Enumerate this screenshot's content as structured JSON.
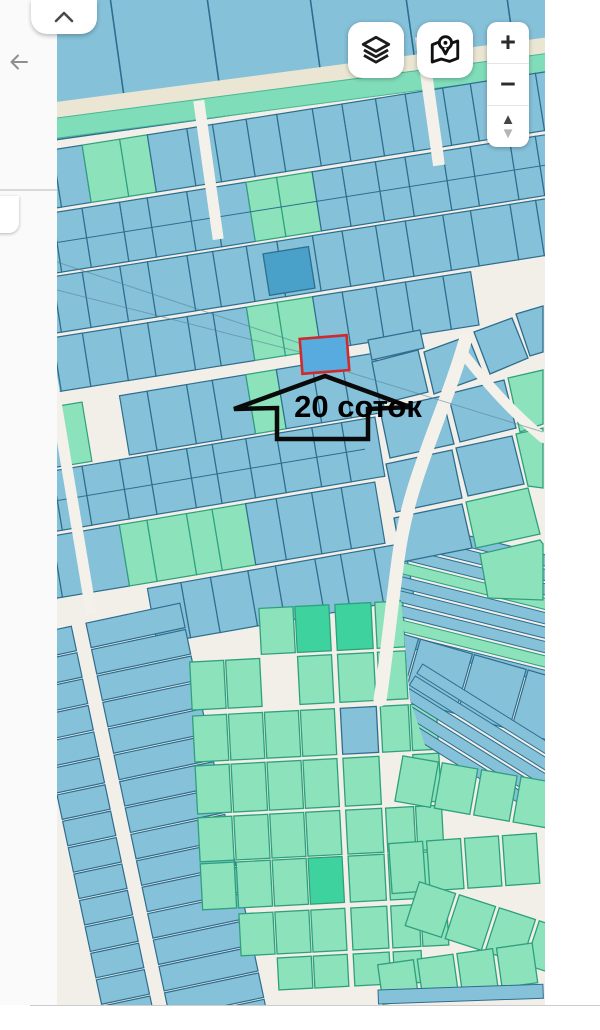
{
  "annotation": {
    "label": "20 соток"
  },
  "controls": {
    "layers": {
      "icon": "layers-icon"
    },
    "legend": {
      "icon": "map-location-icon"
    },
    "zoom": {
      "in": "+",
      "out": "−",
      "up": "▲",
      "down": "▼"
    }
  },
  "left_panel": {
    "back_icon": "arrow-left-icon"
  },
  "top_tab": {
    "icon": "chevron-up-icon"
  },
  "colors": {
    "map_bg": "#f2efe9",
    "parcel_blue": "#85c1d9",
    "parcel_blue_border": "#2e6d8e",
    "parcel_green": "#8ce2bb",
    "parcel_green_border": "#2fa07c",
    "parcel_dark_green": "#3ed39e",
    "parcel_dark_blue": "#49a0c8",
    "selected_fill": "#57abdf",
    "selected_border": "#d02a2a",
    "teal_band": "#80ddb9",
    "teal_band_border": "#49b795",
    "beige_band": "#eae6d3",
    "road_white": "#f4f1ea",
    "annotation_stroke": "#0a0a0a"
  },
  "map": {
    "clip": {
      "x": 57,
      "y": 0,
      "w": 488,
      "h": 1005
    },
    "top_parcels": {
      "rot": -8,
      "cx": 300,
      "cy": 55,
      "y": -70,
      "h": 175,
      "x0": 20,
      "widths": [
        100,
        96,
        102,
        95,
        100,
        95,
        80
      ]
    },
    "bands": {
      "rot": -7.5,
      "cx": 300,
      "cy": 88,
      "beige": {
        "x": 10,
        "y": 70,
        "w": 580,
        "h": 16
      },
      "teal": {
        "x": 10,
        "y": 86,
        "w": 580,
        "h": 20
      }
    },
    "strip_widths": [
      34,
      30,
      38,
      28,
      40,
      26,
      34,
      31,
      36,
      30
    ],
    "strips": [
      {
        "cy": 140,
        "h": 58,
        "rot": -9,
        "x0": 20,
        "x1": 580,
        "greens": [
          [
            85,
            155
          ]
        ]
      },
      {
        "cy": 204,
        "h": 60,
        "rot": -9,
        "x0": 20,
        "x1": 580,
        "greens": [
          [
            245,
            300
          ]
        ],
        "rows2": true
      },
      {
        "cy": 266,
        "h": 56,
        "rot": -9,
        "x0": 20,
        "x1": 580,
        "greens": []
      },
      {
        "cy": 326,
        "h": 54,
        "rot": -9,
        "x0": 20,
        "x1": 460,
        "greens": [
          [
            252,
            302
          ]
        ]
      },
      {
        "cy": 396,
        "h": 60,
        "rot": -9.5,
        "x0": 20,
        "x1": 366,
        "greens": [
          [
            58,
            84
          ],
          [
            250,
            290
          ]
        ],
        "skips": [
          [
            78,
            120
          ]
        ]
      },
      {
        "cy": 460,
        "h": 60,
        "rot": -9.5,
        "x0": 20,
        "x1": 366,
        "greens": [],
        "rows2": true
      },
      {
        "cy": 526,
        "h": 62,
        "rot": -9.5,
        "x0": 20,
        "x1": 366,
        "greens": [
          [
            120,
            210
          ],
          [
            225,
            255
          ]
        ]
      },
      {
        "cy": 590,
        "h": 56,
        "rot": -10,
        "x0": 150,
        "x1": 400,
        "greens": []
      }
    ],
    "slats": {
      "rot": -12,
      "cx": 140,
      "cy": 810,
      "y0": 616,
      "y1": 1040,
      "step": 27,
      "h": 25,
      "runs": [
        [
          62,
          49
        ],
        [
          126,
          96
        ]
      ]
    },
    "cluster": {
      "rot": -3,
      "cx": 310,
      "cy": 780,
      "rows": [
        {
          "y": 606,
          "h": 46
        },
        {
          "y": 656,
          "h": 48
        },
        {
          "y": 710,
          "h": 46
        },
        {
          "y": 760,
          "h": 48
        },
        {
          "y": 812,
          "h": 44
        },
        {
          "y": 858,
          "h": 46
        },
        {
          "y": 910,
          "h": 42
        },
        {
          "y": 956,
          "h": 32
        }
      ],
      "cols": [
        {
          "x": 196,
          "w": 34
        },
        {
          "x": 232,
          "w": 34
        },
        {
          "x": 268,
          "w": 34
        },
        {
          "x": 304,
          "w": 34
        },
        {
          "x": 344,
          "w": 36
        },
        {
          "x": 384,
          "w": 28
        },
        {
          "x": 414,
          "w": 26
        }
      ],
      "skips": [
        "0,0",
        "0,1",
        "0,6",
        "1,6",
        "1,2",
        "6,0",
        "7,0",
        "7,1",
        "7,6",
        "3,5"
      ],
      "darks": [
        "0,3",
        "0,4",
        "5,3"
      ],
      "blues": [
        "2,4"
      ]
    },
    "fan_clip": "392,500 545,500 545,820 450,820 410,700",
    "fanA": {
      "rot": 14,
      "cx": 470,
      "cy": 600,
      "x": 385,
      "w": 185,
      "y0": 538,
      "n": 9,
      "step": 14,
      "h": 11,
      "greens": [
        3,
        7
      ]
    },
    "fanB": {
      "rot": 16,
      "cx": 460,
      "cy": 690,
      "y": 652,
      "h": 62,
      "x0": 352,
      "cw": 54,
      "n": 4
    },
    "fanC": {
      "rot": 32,
      "cx": 490,
      "cy": 745,
      "x": 390,
      "w": 200,
      "y0": 712,
      "n": 5,
      "step": 14,
      "h": 11,
      "greens": []
    },
    "green_rows": [
      {
        "rot": 10,
        "cx": 470,
        "cy": 790,
        "y": 768,
        "h": 46,
        "x0": 398,
        "cw": 36,
        "gap": 4,
        "n": 4
      },
      {
        "rot": -4,
        "cx": 470,
        "cy": 860,
        "y": 838,
        "h": 50,
        "x0": 390,
        "cw": 34,
        "gap": 4,
        "n": 4
      },
      {
        "rot": 18,
        "cx": 490,
        "cy": 930,
        "y": 906,
        "h": 46,
        "x0": 408,
        "cw": 38,
        "gap": 4,
        "n": 4
      },
      {
        "rot": -8,
        "cx": 470,
        "cy": 975,
        "y": 952,
        "h": 40,
        "x0": 380,
        "cw": 36,
        "gap": 4,
        "n": 4
      }
    ],
    "polys": [
      {
        "pts": "368,340 420,330 424,348 372,360",
        "c": "b"
      },
      {
        "pts": "372,362 418,350 428,392 380,404",
        "c": "b"
      },
      {
        "pts": "424,352 468,336 484,376 434,394",
        "c": "b"
      },
      {
        "pts": "474,332 512,318 528,358 490,374",
        "c": "b"
      },
      {
        "pts": "516,314 543,306 543,352 530,356",
        "c": "b"
      },
      {
        "pts": "380,410 442,396 454,444 390,458",
        "c": "b"
      },
      {
        "pts": "448,394 504,380 516,428 460,442",
        "c": "b"
      },
      {
        "pts": "508,378 543,370 543,424 520,432",
        "c": "g"
      },
      {
        "pts": "386,464 452,450 462,498 396,512",
        "c": "b"
      },
      {
        "pts": "456,448 512,436 524,484 468,496",
        "c": "b"
      },
      {
        "pts": "516,434 543,428 543,488 528,486",
        "c": "g"
      },
      {
        "pts": "394,518 462,504 472,548 402,562",
        "c": "b"
      },
      {
        "pts": "466,502 528,488 540,534 476,548",
        "c": "g"
      },
      {
        "pts": "480,554 540,540 543,544 543,600 488,598",
        "c": "g"
      }
    ],
    "road_rects": [
      {
        "x": 203,
        "y": 100,
        "w": 11,
        "h": 140,
        "rot": -8
      },
      {
        "x": 424,
        "y": 36,
        "w": 12,
        "h": 130,
        "rot": -8
      },
      {
        "x": 66,
        "y": 375,
        "w": 11,
        "h": 240,
        "rot": -9.5
      }
    ],
    "road_paths": [
      {
        "d": "M 466,338 C 442,420 408,480 398,560 C 390,620 386,660 380,700",
        "w": 13
      },
      {
        "d": "M 462,352 C 496,396 522,420 543,438",
        "w": 10
      }
    ],
    "quarter_lines": [
      [
        57,
        262,
        302,
        344
      ],
      [
        57,
        290,
        300,
        352
      ],
      [
        348,
        372,
        543,
        432
      ]
    ],
    "dark_parcel": {
      "x": 266,
      "y": 250,
      "w": 46,
      "h": 42,
      "rot": -9
    },
    "blue_bottom": {
      "x": 378,
      "y": 990,
      "w": 165,
      "h": 14,
      "rot": -2
    },
    "selected_parcel": {
      "x": 301,
      "y": 337,
      "w": 47,
      "h": 35,
      "rot": -4.5
    },
    "arrow_points": "325,376 410,407 368,409 368,439 277,439 277,408 234,409",
    "label_pos": {
      "x": 358,
      "y": 417,
      "size": 31
    }
  }
}
